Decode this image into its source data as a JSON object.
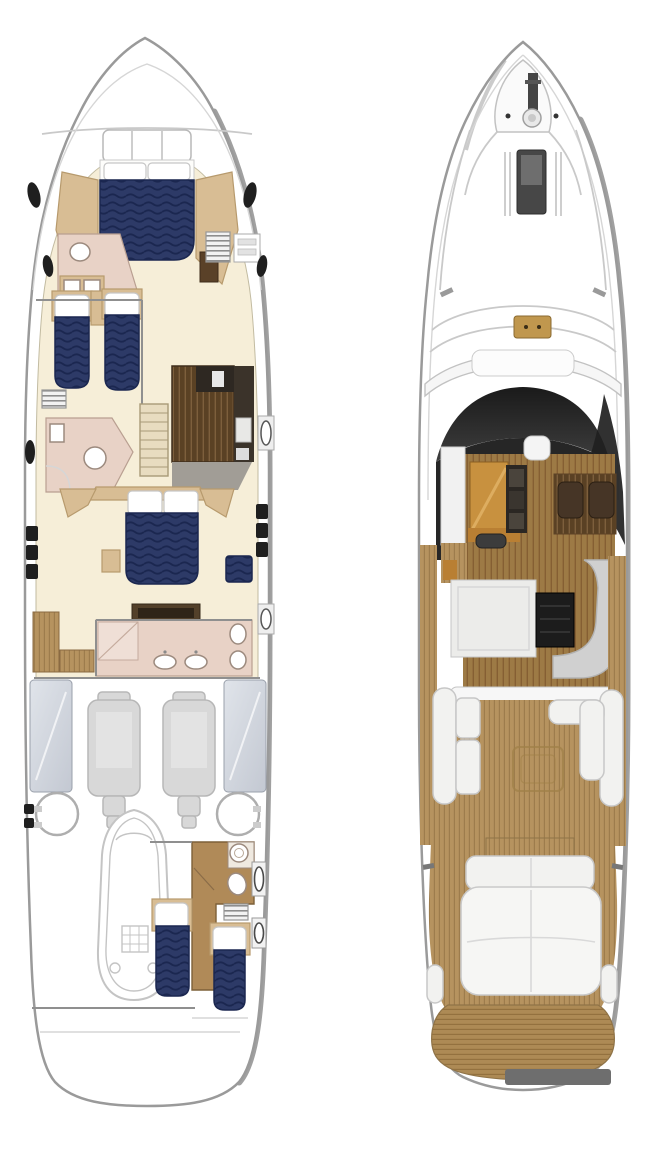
{
  "figure": {
    "views": [
      {
        "id": "lower-deck-plan"
      },
      {
        "id": "main-deck-plan"
      }
    ]
  },
  "palette": {
    "navy": "#2d3a67",
    "navy_line": "#1b2750",
    "cream": "#f6eed8",
    "tan": "#d8bd94",
    "tan_dark": "#b79a6d",
    "pink": "#e8d2c6",
    "pink_line": "#b99f91",
    "wood_dark": "#5a4124",
    "wood_dark_line": "#7d5f3c",
    "teak": "#b6935f",
    "teak_line": "#9d7c4c",
    "salon_wood": "#9d7a45",
    "galley_orange": "#c8913f",
    "hull_line": "#9a9a9a",
    "hull_shadow": "#8f8f8f",
    "engine_gray": "#d8d8d8",
    "tank_gray": "#cfd4dc",
    "sofa_gray": "#d0d0d0",
    "windshield_dark": "#1a1a1a",
    "transom_gray": "#6e6e6e"
  }
}
